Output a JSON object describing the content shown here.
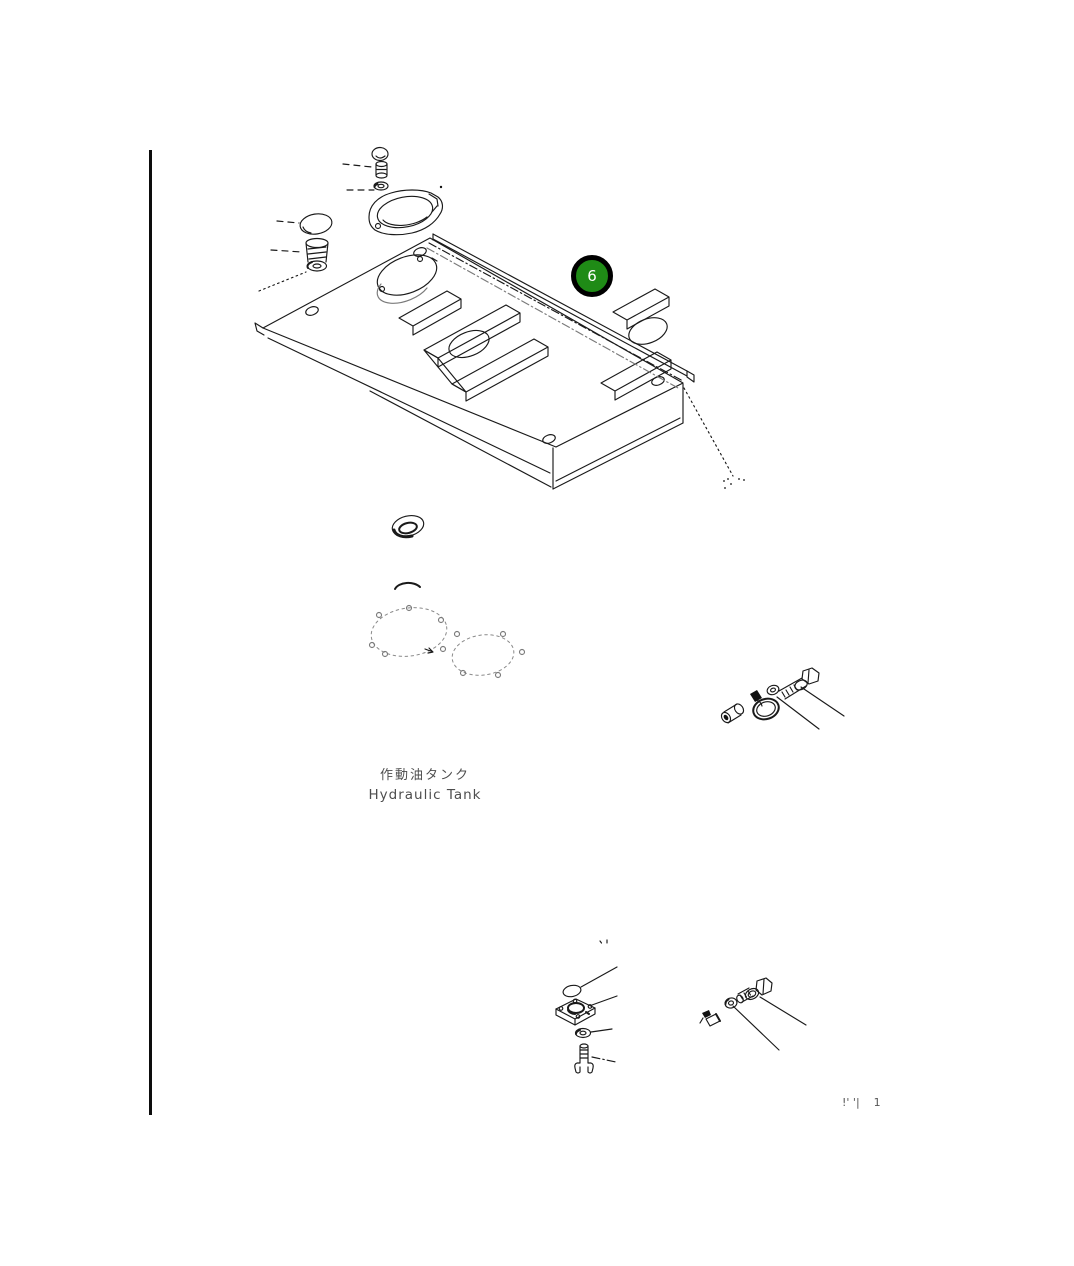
{
  "page": {
    "background": "#ffffff",
    "ink_color": "#1a1a1a",
    "faint_color": "#7a7a7a"
  },
  "callout": {
    "label": "6",
    "fill": "#1f8b16",
    "ring_color": "#000000",
    "label_color": "#ffffff"
  },
  "caption": {
    "ja": "作動油タンク",
    "en": "Hydraulic Tank"
  },
  "corner_note": {
    "marks": "!' '|",
    "number": "1"
  },
  "figures": [
    "hex-bolt-top",
    "sleeve-spacer",
    "flat-washer-top",
    "oval-cover-plate",
    "o-ring-left",
    "threaded-plug",
    "tank-top-cover-panel",
    "edge-rail-strip",
    "breather-cap",
    "cover-gaskets",
    "cylindrical-spacer",
    "hose-clamp",
    "flat-washer-right",
    "hex-bolt-right",
    "o-ring-bottom",
    "flange-plate",
    "flat-washer-bottom",
    "stud-bolt",
    "hex-bolt-bottom-right",
    "lock-nut",
    "wire-clip"
  ]
}
